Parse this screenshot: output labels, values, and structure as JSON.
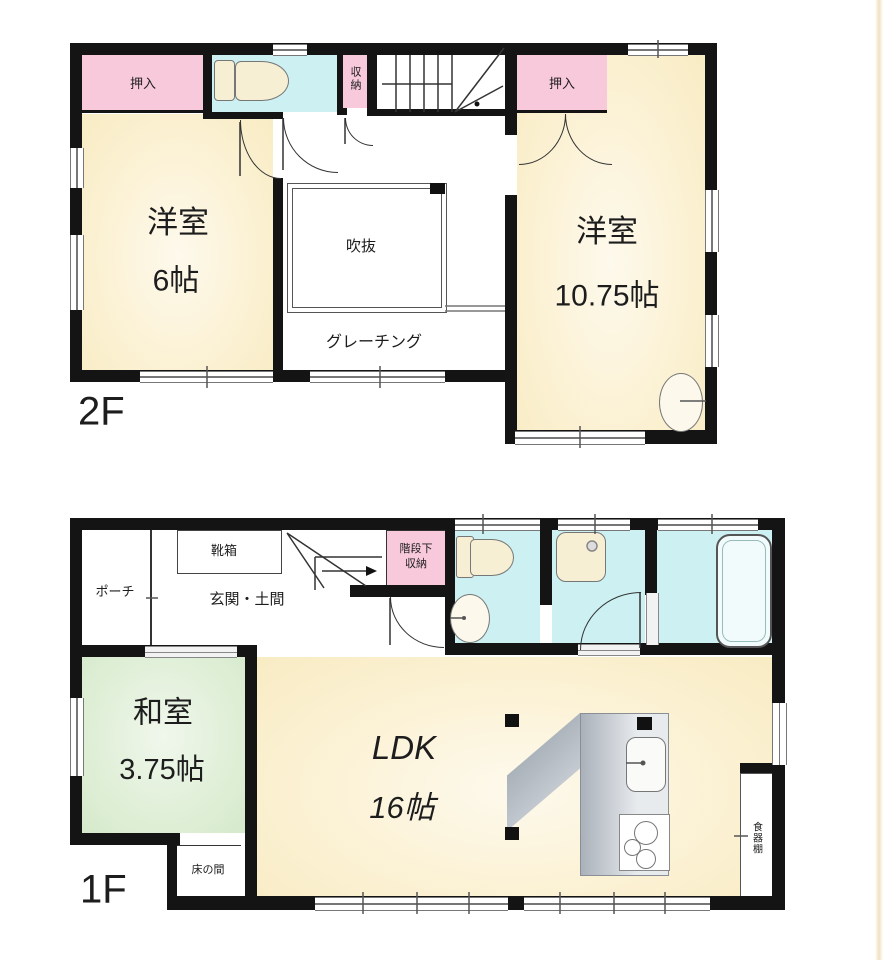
{
  "colors": {
    "closet_pink": "#f8c9db",
    "wet_area_cyan": "#cdf1f3",
    "room_cream": "#fbf0d0",
    "tatami_green": "#ddeed4",
    "wall_black": "#141414",
    "counter_gray": "#aab1ba"
  },
  "floor2": {
    "floor_label": "2F",
    "closet_left": "押入",
    "storage": "収納",
    "closet_right": "押入",
    "room_west": {
      "name": "洋室",
      "size": "6帖"
    },
    "void_label": "吹抜",
    "grating_label": "グレーチング",
    "room_east": {
      "name": "洋室",
      "size": "10.75帖"
    }
  },
  "floor1": {
    "floor_label": "1F",
    "porch": "ポーチ",
    "shoe_cabinet": "靴箱",
    "entrance": "玄関・土間",
    "understairs_storage_line1": "階段下",
    "understairs_storage_line2": "収納",
    "japanese_room": {
      "name": "和室",
      "size": "3.75帖"
    },
    "tokonoma": "床の間",
    "ldk": {
      "name": "LDK",
      "size": "16帖"
    },
    "cupboard": "食器棚"
  }
}
